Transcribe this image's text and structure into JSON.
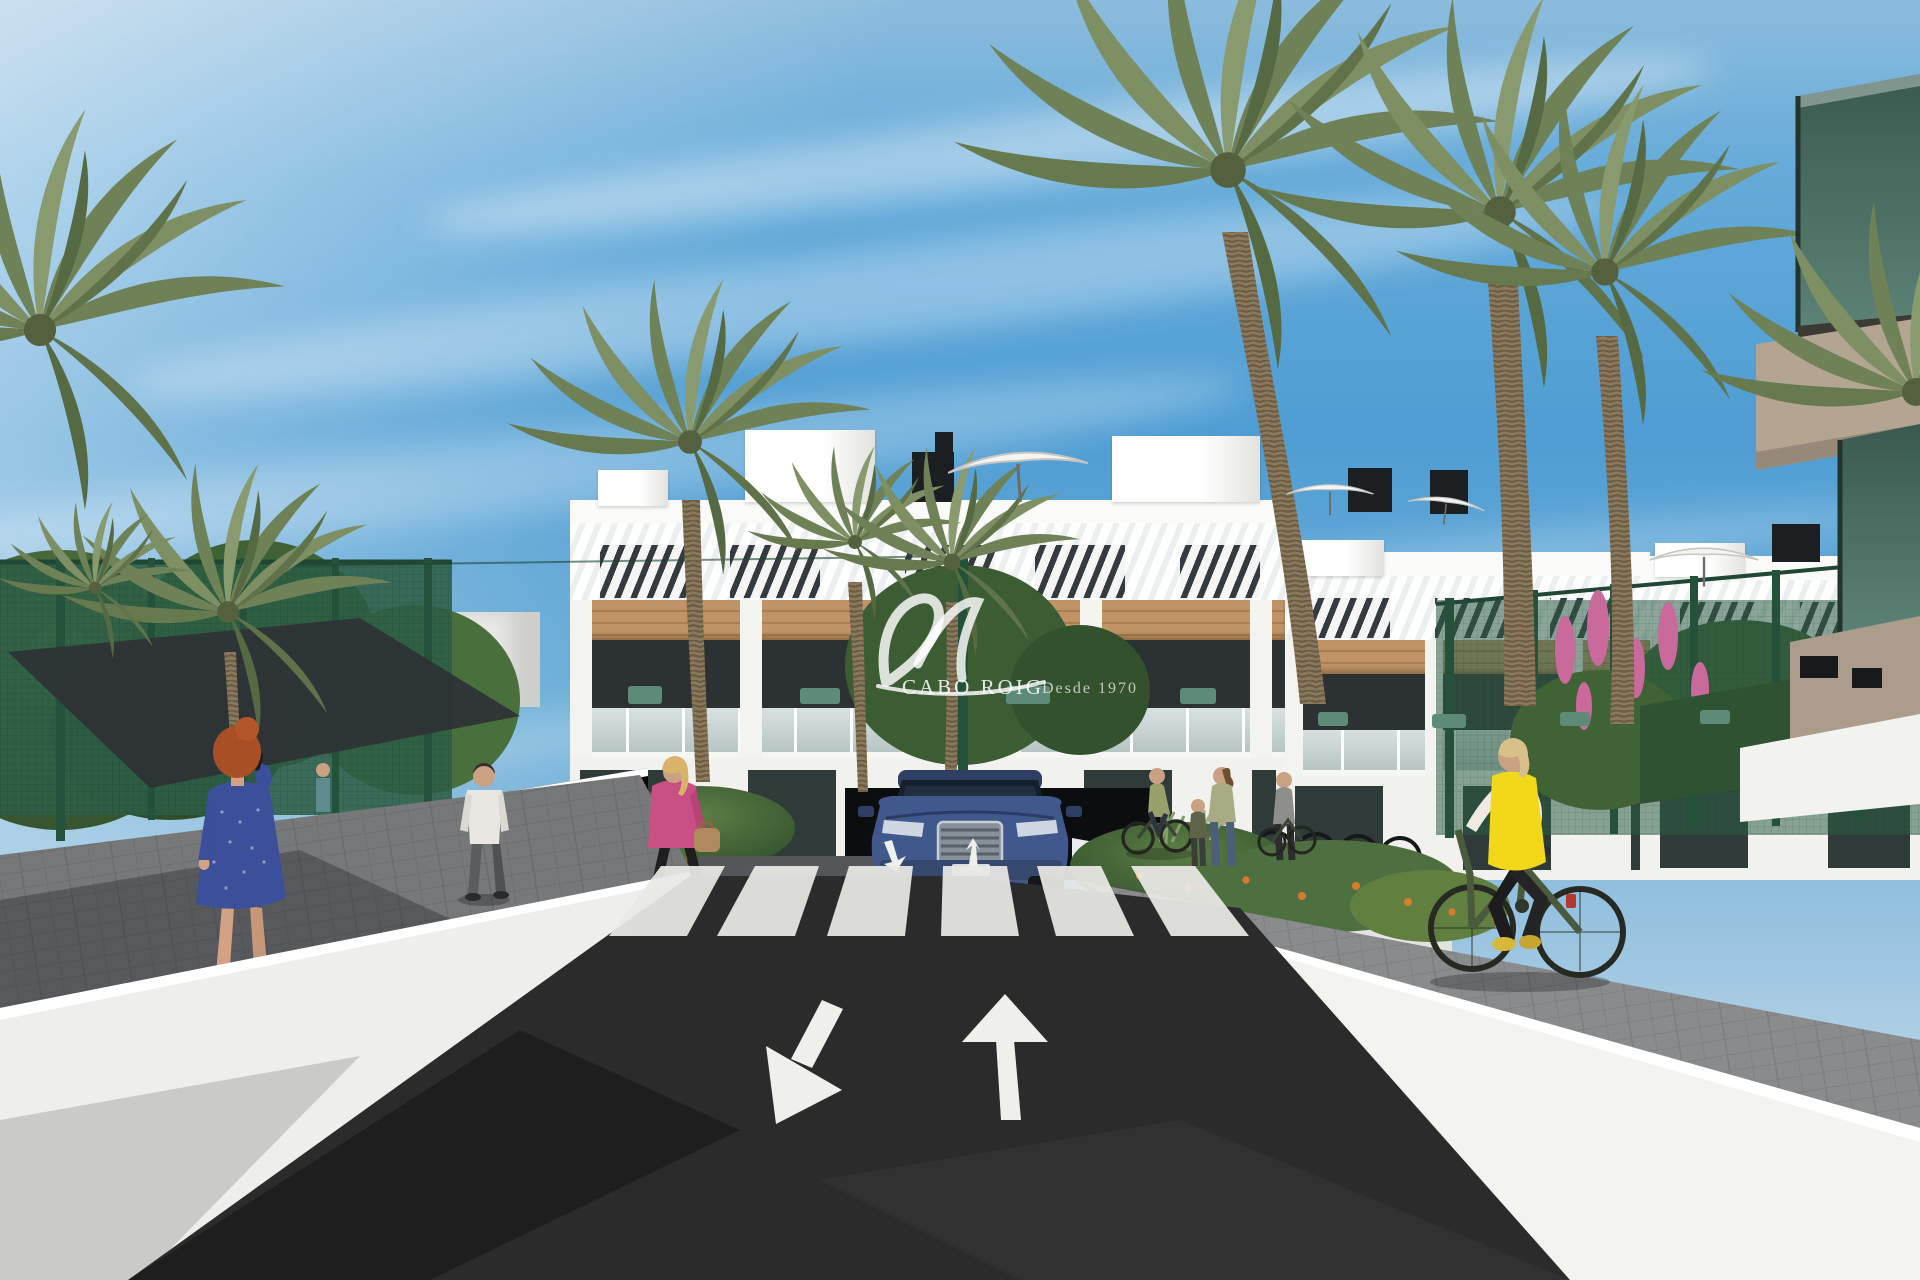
{
  "watermark": {
    "brand": "CABO ROIG",
    "tagline": "Desde 1970",
    "logo": "script-monogram",
    "color": "rgba(255,255,255,0.86)"
  },
  "scene": {
    "type": "architectural-exterior-render",
    "road_markings": {
      "arrows": [
        "arrow-toward-viewer-down-left",
        "arrow-away-up"
      ],
      "crosswalk_stripes": 6,
      "ramp_arrows": 2
    },
    "vehicle": {
      "type": "suv-front-view",
      "body_color": "#41588c"
    },
    "figures": [
      {
        "id": "woman-on-phone",
        "hair": "#a84f26",
        "dress": "#3c4f9a"
      },
      {
        "id": "man-walking-away",
        "shirt": "#e9e7e1"
      },
      {
        "id": "woman-pink-jacket",
        "jacket": "#c94f85"
      },
      {
        "id": "cyclist-yellow-vest",
        "vest": "#f2d818"
      },
      {
        "id": "pedestrians-near-building",
        "count": 4
      },
      {
        "id": "person-on-balcony",
        "count": 1
      }
    ],
    "colors": {
      "sky_top": "#4f9dd3",
      "sky_horizon": "#d8e8f0",
      "building_white": "#f4f4f1",
      "wood_accent": "#b98d60",
      "fence_green": "#2d5c44",
      "asphalt": "#28282b",
      "wall_white": "#eeeeec",
      "walkway_grey": "#77787a",
      "palm_green": "#6f8157",
      "trunk_brown": "#8a795d",
      "marking_white": "#efefec",
      "balcony_glass_teal": "#49695e",
      "soffit_beige": "#b4a492"
    }
  }
}
